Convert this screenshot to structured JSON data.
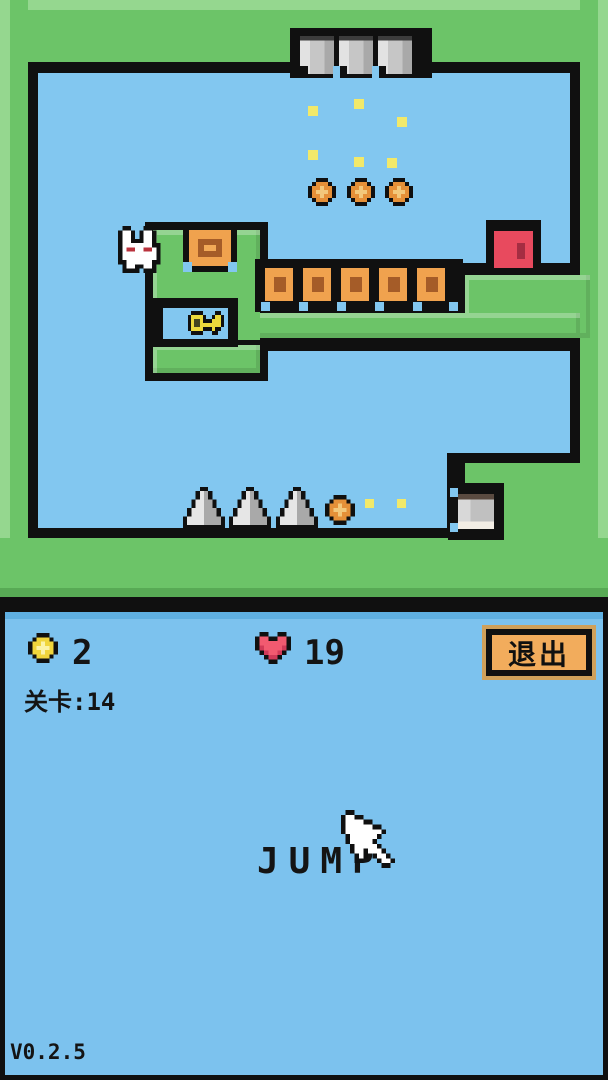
{
  "hud": {
    "coin_count": "2",
    "life_count": "19",
    "level_label": "关卡:14",
    "exit_button_label": "退出",
    "jump_label": "JUMP",
    "version": "V0.2.5"
  },
  "level": {
    "icons": [
      "bunny-icon",
      "key-icon",
      "door-icon",
      "coin-icon",
      "heart-icon",
      "spike-icon",
      "crate-icon",
      "stone-block-icon",
      "cursor-icon",
      "particle-icon"
    ],
    "counts": {
      "coins_in_level": 4,
      "crates": 6,
      "spikes": 3,
      "hanging_stone_blocks": 3,
      "pocket_stone_blocks": 1,
      "doors": 1,
      "keys": 1,
      "particles": 8
    }
  },
  "colors": {
    "frame_black": "#101010",
    "wall_green": "#6cc468",
    "wall_green_light": "#95d78f",
    "wall_green_dark": "#58aa55",
    "sky_blue": "#82c7f0",
    "hud_blue": "#7cc2ee",
    "hud_blue_dark": "#5fb0e2",
    "coin_orange": "#e59038",
    "coin_orange_light": "#f3c87b",
    "coin_yellow": "#f0d53c",
    "coin_yellow_light": "#fbf3a8",
    "heart_red": "#f25a70",
    "heart_red_dark": "#d13a58",
    "door_red": "#e84a5e",
    "door_red_dark": "#a52d42",
    "key_yellow": "#ecd93c",
    "key_hole": "#45451f",
    "crate_orange": "#f0a24e",
    "crate_brown": "#a55c28",
    "button_orange": "#f2ac5c",
    "button_ring": "#cfa05a",
    "stone_gray": "#c9c9c9",
    "spike_light": "#e6e6e6",
    "spike_dark": "#a9a9a9",
    "bunny_white": "#ffffff",
    "bunny_eye": "#b9323c",
    "particle_yellow": "#f2e96a",
    "text_black": "#141414"
  }
}
